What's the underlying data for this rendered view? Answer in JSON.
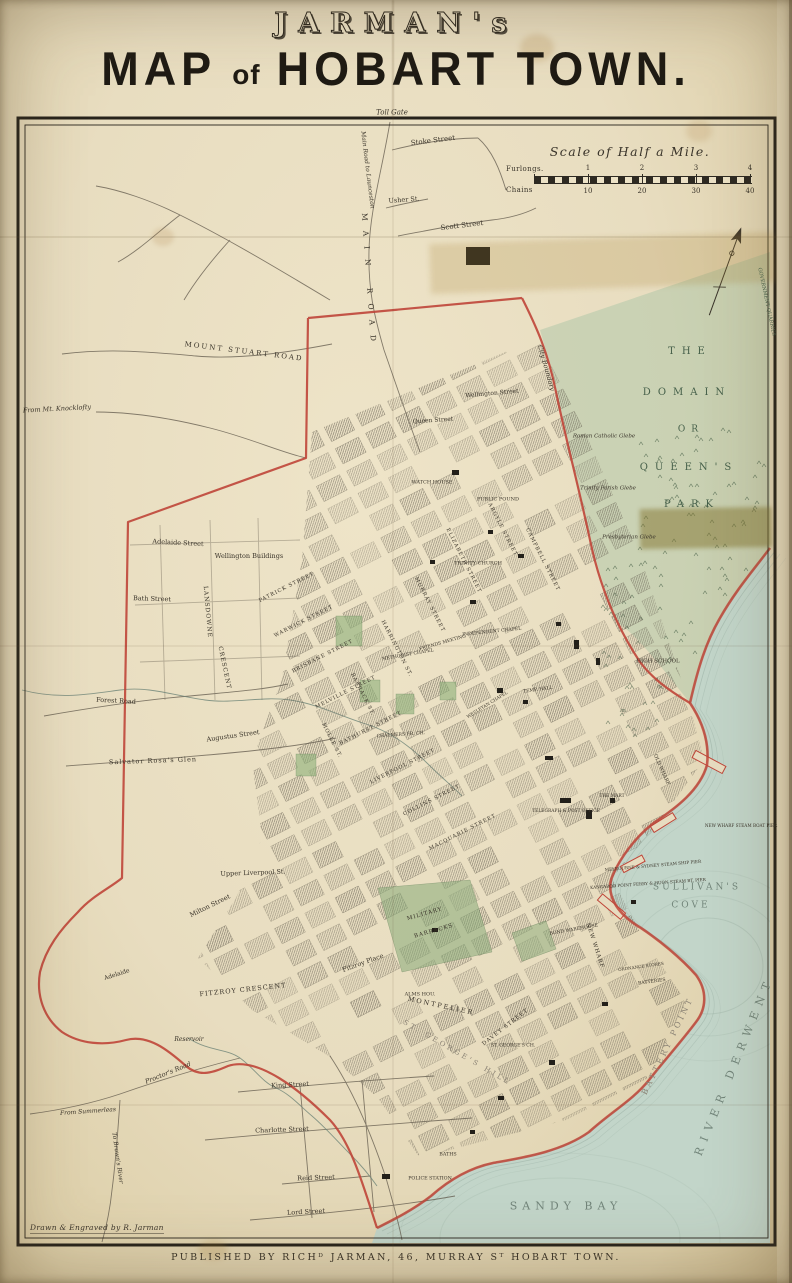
{
  "title": {
    "line1": "JARMAN's",
    "line2_word1": "MAP",
    "line2_word2": "of",
    "line2_word3": "HOBART TOWN."
  },
  "credits": {
    "drawn": "Drawn & Engraved by R. Jarman",
    "published": "PUBLISHED BY RICHᴰ JARMAN, 46, MURRAY Sᵀ HOBART TOWN."
  },
  "scale_bar": {
    "title": "Scale of Half a Mile.",
    "left_top": "Furlongs.",
    "left_bottom": "Chains",
    "furlongs": [
      "1",
      "2",
      "3",
      "4"
    ],
    "chains": [
      "10",
      "20",
      "30",
      "40"
    ]
  },
  "map": {
    "colors": {
      "ink": "#3a342a",
      "water": "#72857a",
      "park": "#46604a",
      "faded": "#8a8274",
      "red": "#bf4538"
    },
    "labels": [
      {
        "text": "Toll Gate",
        "x": 392,
        "y": 113,
        "r": 0,
        "s": 7,
        "i": true
      },
      {
        "text": "Main Road to Launceston",
        "x": 367,
        "y": 170,
        "r": 83,
        "s": 6,
        "i": true
      },
      {
        "text": "Stoke Street",
        "x": 433,
        "y": 141,
        "r": -7,
        "s": 7
      },
      {
        "text": "Usher St.",
        "x": 404,
        "y": 200,
        "r": -4,
        "s": 6.5
      },
      {
        "text": "Scott Street",
        "x": 462,
        "y": 226,
        "r": -7,
        "s": 7
      },
      {
        "text": "MAIN ROAD",
        "x": 369,
        "y": 282,
        "r": 86,
        "s": 7.5,
        "sp": 10
      },
      {
        "text": "MOUNT STUART ROAD",
        "x": 244,
        "y": 352,
        "r": 7,
        "s": 7,
        "sp": 2
      },
      {
        "text": "From Mt. Knocklofty",
        "x": 57,
        "y": 409,
        "r": -3,
        "s": 6.5,
        "i": true
      },
      {
        "text": "City Boundary",
        "x": 546,
        "y": 368,
        "r": 74,
        "s": 6.5,
        "i": true
      },
      {
        "text": "GOVERNMENT QUARRIES",
        "x": 766,
        "y": 302,
        "r": 78,
        "s": 5,
        "c": "park"
      },
      {
        "text": "THE",
        "x": 690,
        "y": 352,
        "r": 0,
        "s": 10,
        "sp": 7,
        "c": "park"
      },
      {
        "text": "DOMAIN",
        "x": 687,
        "y": 393,
        "r": 0,
        "s": 10,
        "sp": 7,
        "c": "park"
      },
      {
        "text": "OR",
        "x": 691,
        "y": 430,
        "r": 0,
        "s": 9,
        "sp": 6,
        "c": "park"
      },
      {
        "text": "QUEEN'S",
        "x": 689,
        "y": 468,
        "r": 0,
        "s": 10,
        "sp": 7,
        "c": "park"
      },
      {
        "text": "PARK",
        "x": 692,
        "y": 505,
        "r": 0,
        "s": 10,
        "sp": 7,
        "c": "park"
      },
      {
        "text": "Roman Catholic Glebe",
        "x": 604,
        "y": 437,
        "r": 0,
        "s": 5.5,
        "i": true
      },
      {
        "text": "Trinity Parish Glebe",
        "x": 608,
        "y": 489,
        "r": 0,
        "s": 5.5,
        "i": true
      },
      {
        "text": "Presbyterian Glebe",
        "x": 629,
        "y": 538,
        "r": 0,
        "s": 5.5,
        "i": true
      },
      {
        "text": "HIGH SCHOOL",
        "x": 658,
        "y": 662,
        "r": 0,
        "s": 5.5
      },
      {
        "text": "Wellington Street",
        "x": 492,
        "y": 394,
        "r": -5,
        "s": 6
      },
      {
        "text": "Queen Street",
        "x": 433,
        "y": 421,
        "r": -4,
        "s": 6
      },
      {
        "text": "WATCH HOUSE",
        "x": 432,
        "y": 483,
        "r": 0,
        "s": 5
      },
      {
        "text": "PUBLIC POUND",
        "x": 498,
        "y": 500,
        "r": 0,
        "s": 5
      },
      {
        "text": "TRINITY CHURCH",
        "x": 478,
        "y": 564,
        "r": 0,
        "s": 5
      },
      {
        "text": "Wellington Buildings",
        "x": 249,
        "y": 556,
        "r": 0,
        "s": 6.5
      },
      {
        "text": "Adelaide Street",
        "x": 178,
        "y": 543,
        "r": 3,
        "s": 6.5
      },
      {
        "text": "Bath Street",
        "x": 152,
        "y": 599,
        "r": 2,
        "s": 6.5
      },
      {
        "text": "LANSDOWNE",
        "x": 207,
        "y": 612,
        "r": 85,
        "s": 6,
        "sp": 1
      },
      {
        "text": "CRESCENT",
        "x": 224,
        "y": 668,
        "r": 78,
        "s": 6,
        "sp": 1
      },
      {
        "text": "Forest Road",
        "x": 116,
        "y": 701,
        "r": 3,
        "s": 6.5
      },
      {
        "text": "Salvator Rosa's Glen",
        "x": 153,
        "y": 761,
        "r": -2,
        "s": 6.5,
        "sp": 1
      },
      {
        "text": "Augustus Street",
        "x": 233,
        "y": 736,
        "r": -8,
        "s": 6.5
      },
      {
        "text": "Upper Liverpool St.",
        "x": 253,
        "y": 873,
        "r": -2,
        "s": 6.5
      },
      {
        "text": "Milton Street",
        "x": 210,
        "y": 906,
        "r": -26,
        "s": 6.5
      },
      {
        "text": "PATRICK STREET",
        "x": 287,
        "y": 588,
        "r": -27,
        "s": 5.2,
        "sp": 1
      },
      {
        "text": "WARWICK STREET",
        "x": 304,
        "y": 622,
        "r": -27,
        "s": 5.2,
        "sp": 1
      },
      {
        "text": "BRISBANE STREET",
        "x": 323,
        "y": 657,
        "r": -27,
        "s": 5.2,
        "sp": 1
      },
      {
        "text": "MELVILLE STREET",
        "x": 346,
        "y": 693,
        "r": -27,
        "s": 5.2,
        "sp": 1
      },
      {
        "text": "BATHURST STREET",
        "x": 371,
        "y": 729,
        "r": -27,
        "s": 5.2,
        "sp": 1
      },
      {
        "text": "LIVERPOOL STREET",
        "x": 403,
        "y": 767,
        "r": -27,
        "s": 5.2,
        "sp": 1
      },
      {
        "text": "COLLINS STREET",
        "x": 432,
        "y": 801,
        "r": -27,
        "s": 5.2,
        "sp": 1
      },
      {
        "text": "MACQUARIE STREET",
        "x": 463,
        "y": 833,
        "r": -27,
        "s": 5.2,
        "sp": 1
      },
      {
        "text": "MOLLE ST.",
        "x": 331,
        "y": 741,
        "r": 63,
        "s": 5.2,
        "sp": 1
      },
      {
        "text": "BARRACK ST.",
        "x": 362,
        "y": 695,
        "r": 63,
        "s": 5.2,
        "sp": 1
      },
      {
        "text": "HARRINGTON ST.",
        "x": 396,
        "y": 649,
        "r": 63,
        "s": 5.2,
        "sp": 1
      },
      {
        "text": "MURRAY STREET",
        "x": 429,
        "y": 605,
        "r": 63,
        "s": 5.2,
        "sp": 1
      },
      {
        "text": "ELIZABETH STREET",
        "x": 463,
        "y": 561,
        "r": 63,
        "s": 5.2,
        "sp": 1
      },
      {
        "text": "ARGYLE STREET",
        "x": 502,
        "y": 530,
        "r": 63,
        "s": 5.2,
        "sp": 1
      },
      {
        "text": "CAMPBELL STREET",
        "x": 542,
        "y": 560,
        "r": 63,
        "s": 5.2,
        "sp": 1
      },
      {
        "text": "INDEPENDENT CHAPEL",
        "x": 492,
        "y": 633,
        "r": -6,
        "s": 4.6
      },
      {
        "text": "FRIENDS MEETING",
        "x": 443,
        "y": 644,
        "r": -16,
        "s": 4.6
      },
      {
        "text": "METHODIST CHAPEL",
        "x": 408,
        "y": 656,
        "r": -10,
        "s": 4.6
      },
      {
        "text": "WESLEYAN CHAPEL",
        "x": 488,
        "y": 706,
        "r": -32,
        "s": 4.4
      },
      {
        "text": "TEMP. HALL",
        "x": 538,
        "y": 691,
        "r": -8,
        "s": 4.6
      },
      {
        "text": "CHALMERS FR. CH.",
        "x": 401,
        "y": 736,
        "r": -4,
        "s": 4.6
      },
      {
        "text": "TELEGRAPH & POST OFFICE",
        "x": 566,
        "y": 812,
        "r": 0,
        "s": 4.4
      },
      {
        "text": "THE MART",
        "x": 612,
        "y": 797,
        "r": 0,
        "s": 4.4
      },
      {
        "text": "OLD WHARF",
        "x": 661,
        "y": 770,
        "r": 66,
        "s": 5
      },
      {
        "text": "NEW WHARF",
        "x": 594,
        "y": 946,
        "r": 72,
        "s": 5.5,
        "sp": 1
      },
      {
        "text": "NEW WHARF STEAM BOAT PIER",
        "x": 741,
        "y": 826,
        "r": 0,
        "s": 4.2
      },
      {
        "text": "MELBOURNE & SYDNEY STEAM SHIP PIER",
        "x": 653,
        "y": 866,
        "r": -5,
        "s": 4.2
      },
      {
        "text": "KANGAROO POINT FERRY & HUON STEAM BT. PIER",
        "x": 648,
        "y": 884,
        "r": -4,
        "s": 4.2
      },
      {
        "text": "SULLIVAN'S",
        "x": 697,
        "y": 888,
        "r": 0,
        "s": 9,
        "sp": 3,
        "c": "water"
      },
      {
        "text": "COVE",
        "x": 691,
        "y": 906,
        "r": 0,
        "s": 9,
        "sp": 3,
        "c": "water"
      },
      {
        "text": "BOND WAREHOUSE",
        "x": 574,
        "y": 931,
        "r": -10,
        "s": 4.6
      },
      {
        "text": "ORDNANCE STORES",
        "x": 641,
        "y": 967,
        "r": -8,
        "s": 4.2
      },
      {
        "text": "BATTERIES",
        "x": 652,
        "y": 983,
        "r": -8,
        "s": 4.6
      },
      {
        "text": "BATTERY POINT",
        "x": 668,
        "y": 1046,
        "r": -64,
        "s": 8,
        "sp": 3,
        "c": "faded"
      },
      {
        "text": "MILITARY",
        "x": 425,
        "y": 915,
        "r": -16,
        "s": 5.5,
        "sp": 1
      },
      {
        "text": "BARRACKS",
        "x": 434,
        "y": 932,
        "r": -16,
        "s": 5.5,
        "sp": 1
      },
      {
        "text": "ALMS HOU.",
        "x": 420,
        "y": 995,
        "r": 0,
        "s": 5
      },
      {
        "text": "MONTPELIER",
        "x": 441,
        "y": 1006,
        "r": 12,
        "s": 6.5,
        "sp": 2
      },
      {
        "text": "ST. GEORGE'S HILL",
        "x": 457,
        "y": 1053,
        "r": 30,
        "s": 7,
        "sp": 3,
        "c": "faded"
      },
      {
        "text": "ST. GEORGE'S CH.",
        "x": 513,
        "y": 1047,
        "r": 0,
        "s": 4.6
      },
      {
        "text": "DAVEY STREET",
        "x": 506,
        "y": 1028,
        "r": -38,
        "s": 5.5,
        "sp": 1
      },
      {
        "text": "Fitzroy Place",
        "x": 363,
        "y": 963,
        "r": -20,
        "s": 6.5
      },
      {
        "text": "FITZROY CRESCENT",
        "x": 243,
        "y": 990,
        "r": -6,
        "s": 6.5,
        "sp": 1
      },
      {
        "text": "Reservoir",
        "x": 189,
        "y": 1040,
        "r": 0,
        "s": 6,
        "i": true
      },
      {
        "text": "Proctor's Road",
        "x": 168,
        "y": 1073,
        "r": -22,
        "s": 6.5,
        "i": true
      },
      {
        "text": "Adelaide",
        "x": 117,
        "y": 975,
        "r": -18,
        "s": 6
      },
      {
        "text": "From Summerleas",
        "x": 88,
        "y": 1112,
        "r": -4,
        "s": 6,
        "i": true
      },
      {
        "text": "To Brown's River",
        "x": 117,
        "y": 1158,
        "r": 82,
        "s": 6,
        "i": true
      },
      {
        "text": "King Street",
        "x": 290,
        "y": 1085,
        "r": -3,
        "s": 6.5
      },
      {
        "text": "Charlotte Street",
        "x": 282,
        "y": 1130,
        "r": -2,
        "s": 6.5
      },
      {
        "text": "Reid Street",
        "x": 316,
        "y": 1178,
        "r": -2,
        "s": 6.5
      },
      {
        "text": "Lord Street",
        "x": 306,
        "y": 1212,
        "r": -3,
        "s": 6.5
      },
      {
        "text": "POLICE STATION",
        "x": 430,
        "y": 1180,
        "r": 0,
        "s": 4.8
      },
      {
        "text": "BATHS",
        "x": 448,
        "y": 1156,
        "r": 0,
        "s": 4.8
      },
      {
        "text": "SANDY BAY",
        "x": 566,
        "y": 1206,
        "r": 0,
        "s": 11,
        "sp": 5,
        "c": "water"
      },
      {
        "text": "RIVER DERWENT",
        "x": 734,
        "y": 1066,
        "r": -68,
        "s": 11,
        "sp": 7,
        "c": "water"
      }
    ]
  }
}
